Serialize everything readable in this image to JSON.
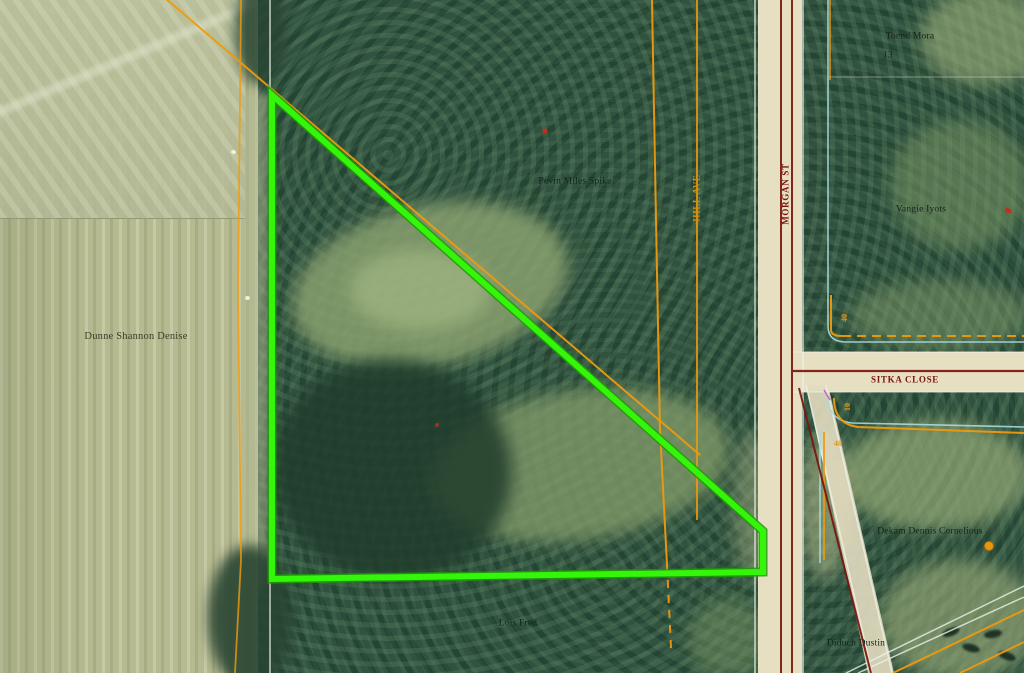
{
  "map": {
    "parcel": {
      "points": "272,95 763,531 763,572 272,579",
      "highlight_color": "#35f50a"
    },
    "streets": {
      "morgan": "MORGAN ST",
      "hill": "HILL AVE",
      "sitka": "SITKA CLOSE"
    },
    "owners": {
      "field_west": "Dunne Shannon Denise",
      "northeast": "Toend Mora",
      "northeast_lot": "13",
      "east": "Vangie Iyots",
      "center": "Pevin Miles Spike",
      "southeast": "Dekam Dennis Cornelious",
      "south": "Lois Fred",
      "southeast_corner": "Diduch Dustin"
    },
    "survey_numbers": {
      "ne_forty": "40",
      "se_ten": "10",
      "se_forty": "40"
    },
    "colors": {
      "parcel_highlight": "#35f50a",
      "survey_orange": "#ef9a0e",
      "road_red": "#7a150e",
      "boundary_blue": "#a8dade",
      "road_surface": "#e7dfc2",
      "field": "#b6ba90",
      "forest": "#30523f"
    }
  }
}
